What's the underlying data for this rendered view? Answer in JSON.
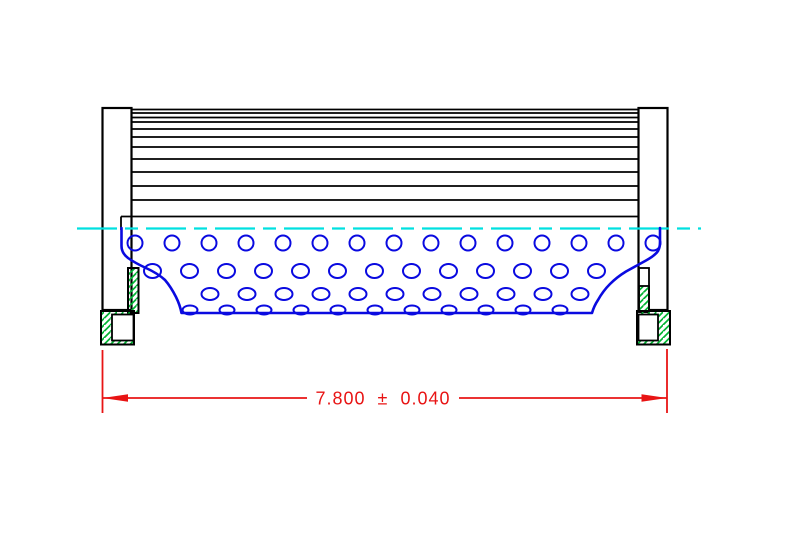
{
  "dimension": {
    "label": "7.800 ± 0.040",
    "value": "7.800",
    "tolerance": "0.040",
    "plus_minus_symbol": "±"
  },
  "colors": {
    "outline": "#000000",
    "media_blue": "#0a0ae0",
    "centerline_cyan": "#00e0e0",
    "hatch_green": "#00b432",
    "dim_red": "#e81414",
    "paper": "#ffffff"
  },
  "geometry": {
    "pleat_lines": {
      "x1": 131,
      "x2": 639,
      "ys": [
        109.5,
        113,
        117.5,
        122,
        129,
        137,
        147,
        159,
        172,
        186,
        200
      ]
    },
    "bottom_pleat_line": {
      "x1": 121,
      "x2": 639,
      "y": 216.5
    },
    "centerline": {
      "x1": 77,
      "x2": 701,
      "y": 228.5,
      "dash": "40 8 13 8"
    },
    "hole_rows": [
      {
        "y": 243,
        "rx": 7.5,
        "ry": 7.5,
        "start": 135,
        "step": 37,
        "count": 15
      },
      {
        "y": 271,
        "rx": 8.5,
        "ry": 7,
        "start": 152.5,
        "step": 37,
        "count": 13
      },
      {
        "y": 294,
        "rx": 8.5,
        "ry": 6,
        "start": 210,
        "step": 37,
        "count": 11
      },
      {
        "y": 310,
        "rx": 7.5,
        "ry": 4.5,
        "start": 190,
        "step": 37,
        "count": 11
      }
    ]
  }
}
